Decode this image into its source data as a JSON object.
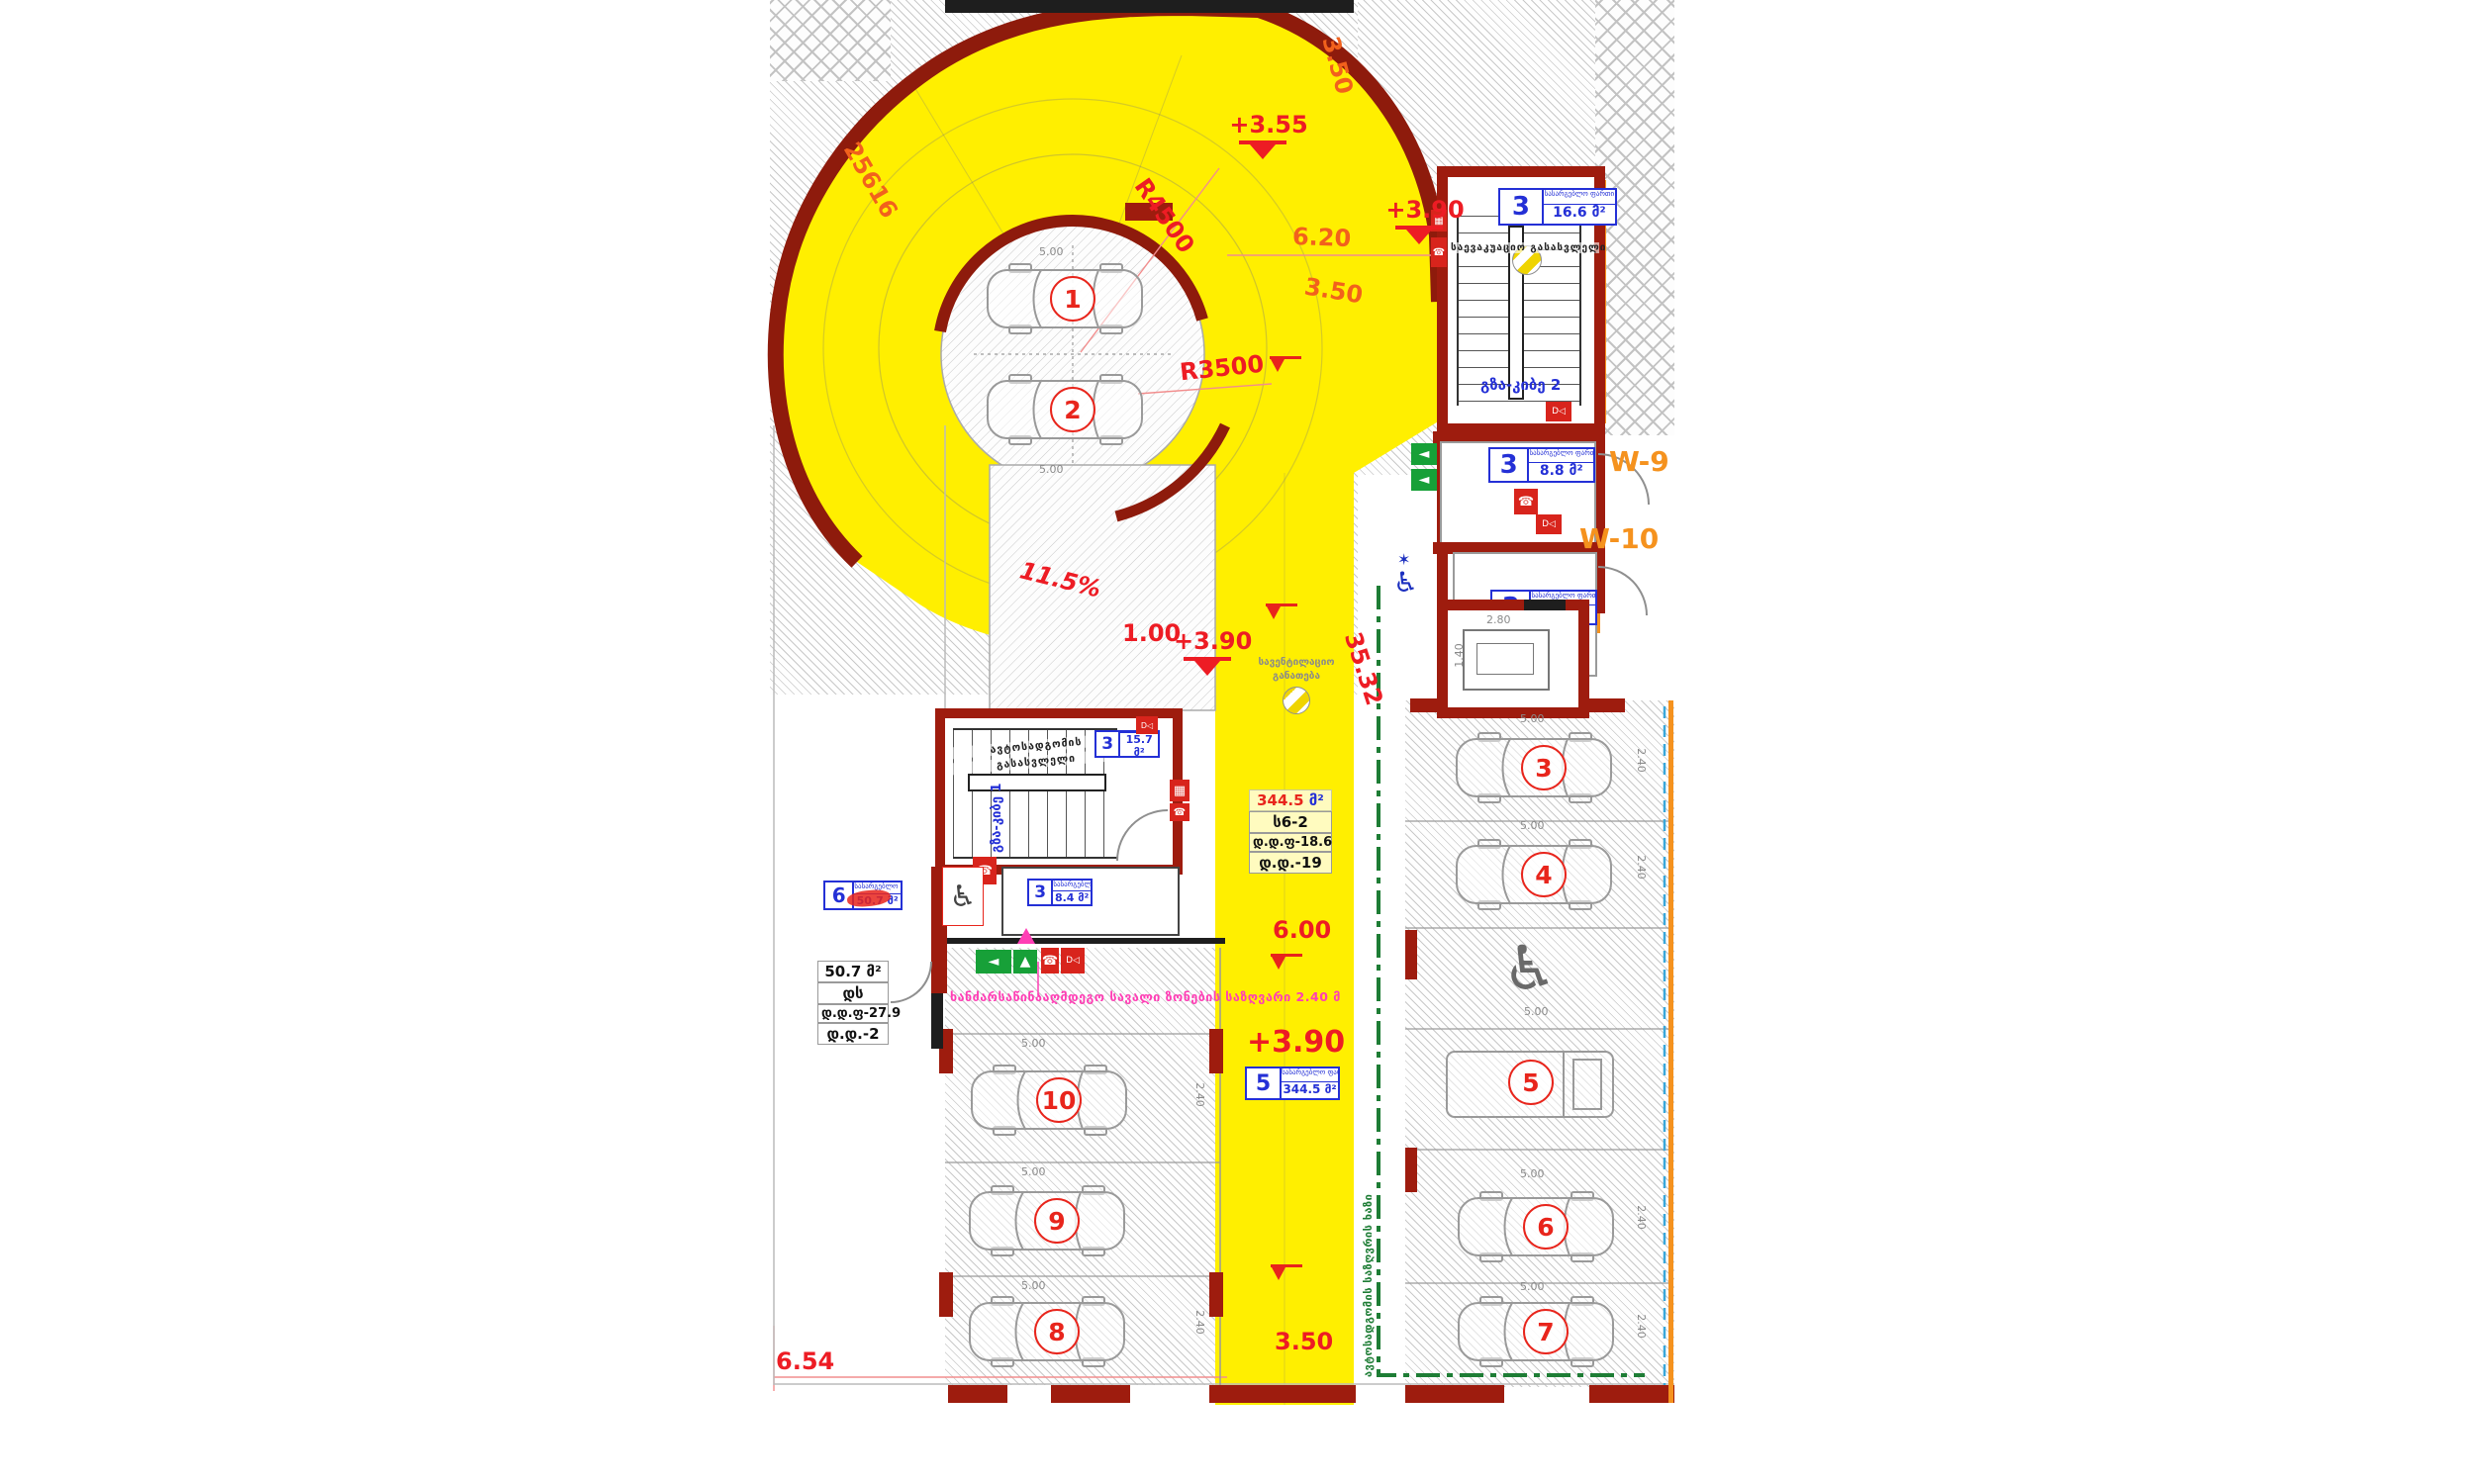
{
  "colors": {
    "ramp_yellow": "#ffef00",
    "wall_maroon": "#9e1c0e",
    "dim_red": "#ed1c24",
    "dim_orange": "#f2611c",
    "tag_blue": "#2430d6",
    "accent_orange": "#f5921e",
    "boundary_green": "#1e7d35",
    "safety_magenta": "#ff3eb5"
  },
  "dims": {
    "level_355": "+3.55",
    "level_390_top": "+3.90",
    "level_390_mid": "+3.90",
    "level_390_low": "+3.90",
    "r4500": "R4500",
    "r3500": "R3500",
    "w620": "6.20",
    "w350_top": "3.50",
    "w350_mid": "3.50",
    "w350_bot": "3.50",
    "arc_len": "25616",
    "slope": "11.5%",
    "w100": "1.00",
    "l3532": "35.32",
    "w600": "6.00",
    "w654": "6.54",
    "spot_len": "5.00",
    "spot_wid": "2.40",
    "elev_w": "2.80",
    "elev_d": "1.40"
  },
  "tags": {
    "stair2": {
      "num": "3",
      "caption": "სასარგებლო ფართი",
      "area": "16.6 მ²"
    },
    "w9": {
      "num": "3",
      "caption": "სასარგებლო ფართი",
      "area": "8.8 მ²"
    },
    "w10": {
      "num": "3",
      "caption": "სასარგებლო ფართი",
      "area": "8.8 მ²"
    },
    "stair1": {
      "num": "3",
      "caption": "სასარგებლო ფართი",
      "area": "15.7 მ²"
    },
    "room84": {
      "num": "3",
      "caption": "სასარგებლო ფართი",
      "area": "8.4 მ²"
    },
    "room6": {
      "num": "6",
      "caption": "სასარგებლო ფართი",
      "area": "50.7 მ²"
    },
    "ramp": {
      "num": "5",
      "caption": "სასარგებლო ფართი",
      "area": "344.5 მ²"
    }
  },
  "info_ramp": {
    "area_num": "344.5",
    "area_unit": "მ²",
    "code": "ს6-2",
    "line1": "დ.დ.ფ-18.6",
    "line2": "დ.დ.-19"
  },
  "info_left": {
    "line1": "50.7 მ²",
    "line2": "დს",
    "line3": "დ.დ.ფ-27.9",
    "line4": "დ.დ.-2"
  },
  "labels": {
    "w9": "W-9",
    "w10": "W-10",
    "stair2_name": "გზა-კიბე 2",
    "stair1_name": "გზა-კიბე 1",
    "evac_exit": "საევაკუაციო გასასვლელი",
    "parking_exit_1": "ავტოსადგომის",
    "parking_exit_2": "გასასვლელი",
    "vent_1": "სავენტილაციო",
    "vent_2": "განათება",
    "fire_zone": "ხანძარსაწინააღმდეგო სავალი ზონების საზღვარი 2.40 მ",
    "boundary": "ავტოსადგომის საზღვრის ხაზი"
  },
  "spots": {
    "s1": "1",
    "s2": "2",
    "s3": "3",
    "s4": "4",
    "s5": "5",
    "s6": "6",
    "s7": "7",
    "s8": "8",
    "s9": "9",
    "s10": "10"
  },
  "icons": {
    "phone": "☎",
    "extinguisher": "D◁",
    "hydrant": "▦",
    "arrow_up": "▲",
    "arrow_left": "◄",
    "star_of_life": "✶",
    "wheelchair": "♿"
  }
}
